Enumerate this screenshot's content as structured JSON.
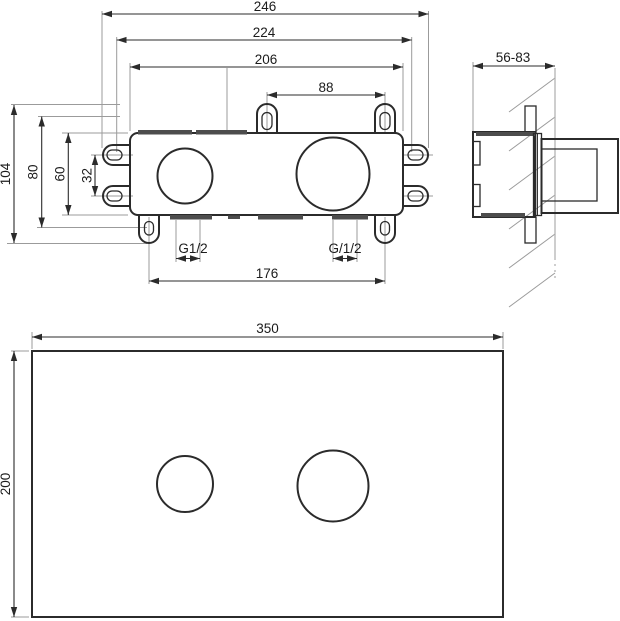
{
  "drawing": {
    "front_view": {
      "width_overall": "246",
      "width_mount_slots": "224",
      "width_body": "206",
      "top_lug_spacing": "88",
      "height_overall": "104",
      "lug_row_spacing": "80",
      "height_body": "60",
      "side_lug_spacing": "32",
      "bottom_lug_spacing": "176",
      "left_connection": "G1/2",
      "right_connection": "G/1/2"
    },
    "side_view": {
      "install_depth_range": "56-83"
    },
    "trim_plate_view": {
      "width": "350",
      "height": "200"
    },
    "colors": {
      "object_line": "#2b2b2b",
      "extension_line": "#9b9b9b",
      "port_strip": "#4d4d4d",
      "wall_line": "#b3b3b3",
      "background": "#ffffff"
    }
  }
}
